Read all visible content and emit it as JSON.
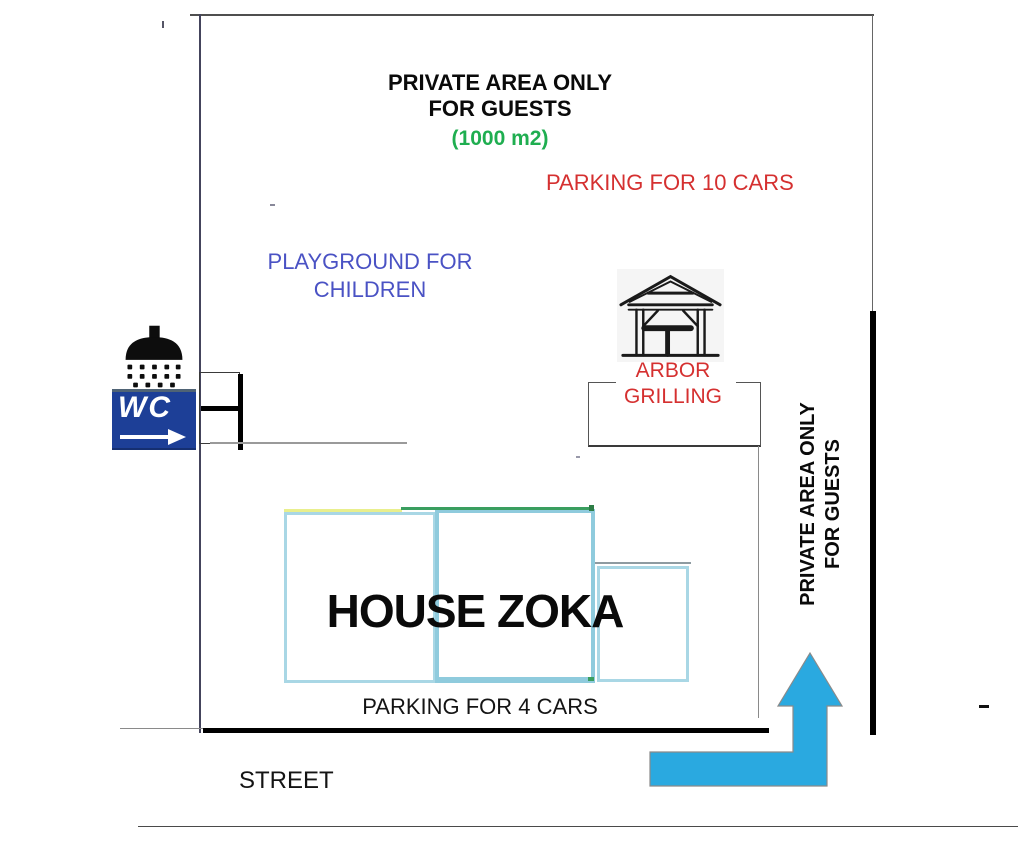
{
  "plan": {
    "header": {
      "line1": "PRIVATE AREA ONLY",
      "line2": "FOR GUESTS",
      "area": "(1000 m2)"
    },
    "labels": {
      "parking_large": "PARKING FOR 10 CARS",
      "playground_line1": "PLAYGROUND FOR",
      "playground_line2": "CHILDREN",
      "arbor_line1": "ARBOR",
      "arbor_line2": "GRILLING",
      "house": "HOUSE ZOKA",
      "parking_small": "PARKING FOR 4 CARS",
      "street": "STREET",
      "side_line1": "PRIVATE AREA ONLY",
      "side_line2": "FOR GUESTS",
      "wc_sign": "WC"
    },
    "icons": {
      "shower": "shower-icon",
      "wc": "wc-sign",
      "arbor": "gazebo-icon",
      "entrance": "entrance-arrow"
    },
    "colors": {
      "area_green": "#1fae50",
      "label_red": "#d53030",
      "playground_blue": "#4a52c4",
      "arrow_blue": "#2aa9e0",
      "house_border_blue": "#a9d7e5",
      "wc_background": "#1d3f97",
      "roof_yellow": "#e9ef8d",
      "roof_green": "#3a9e5f"
    }
  }
}
